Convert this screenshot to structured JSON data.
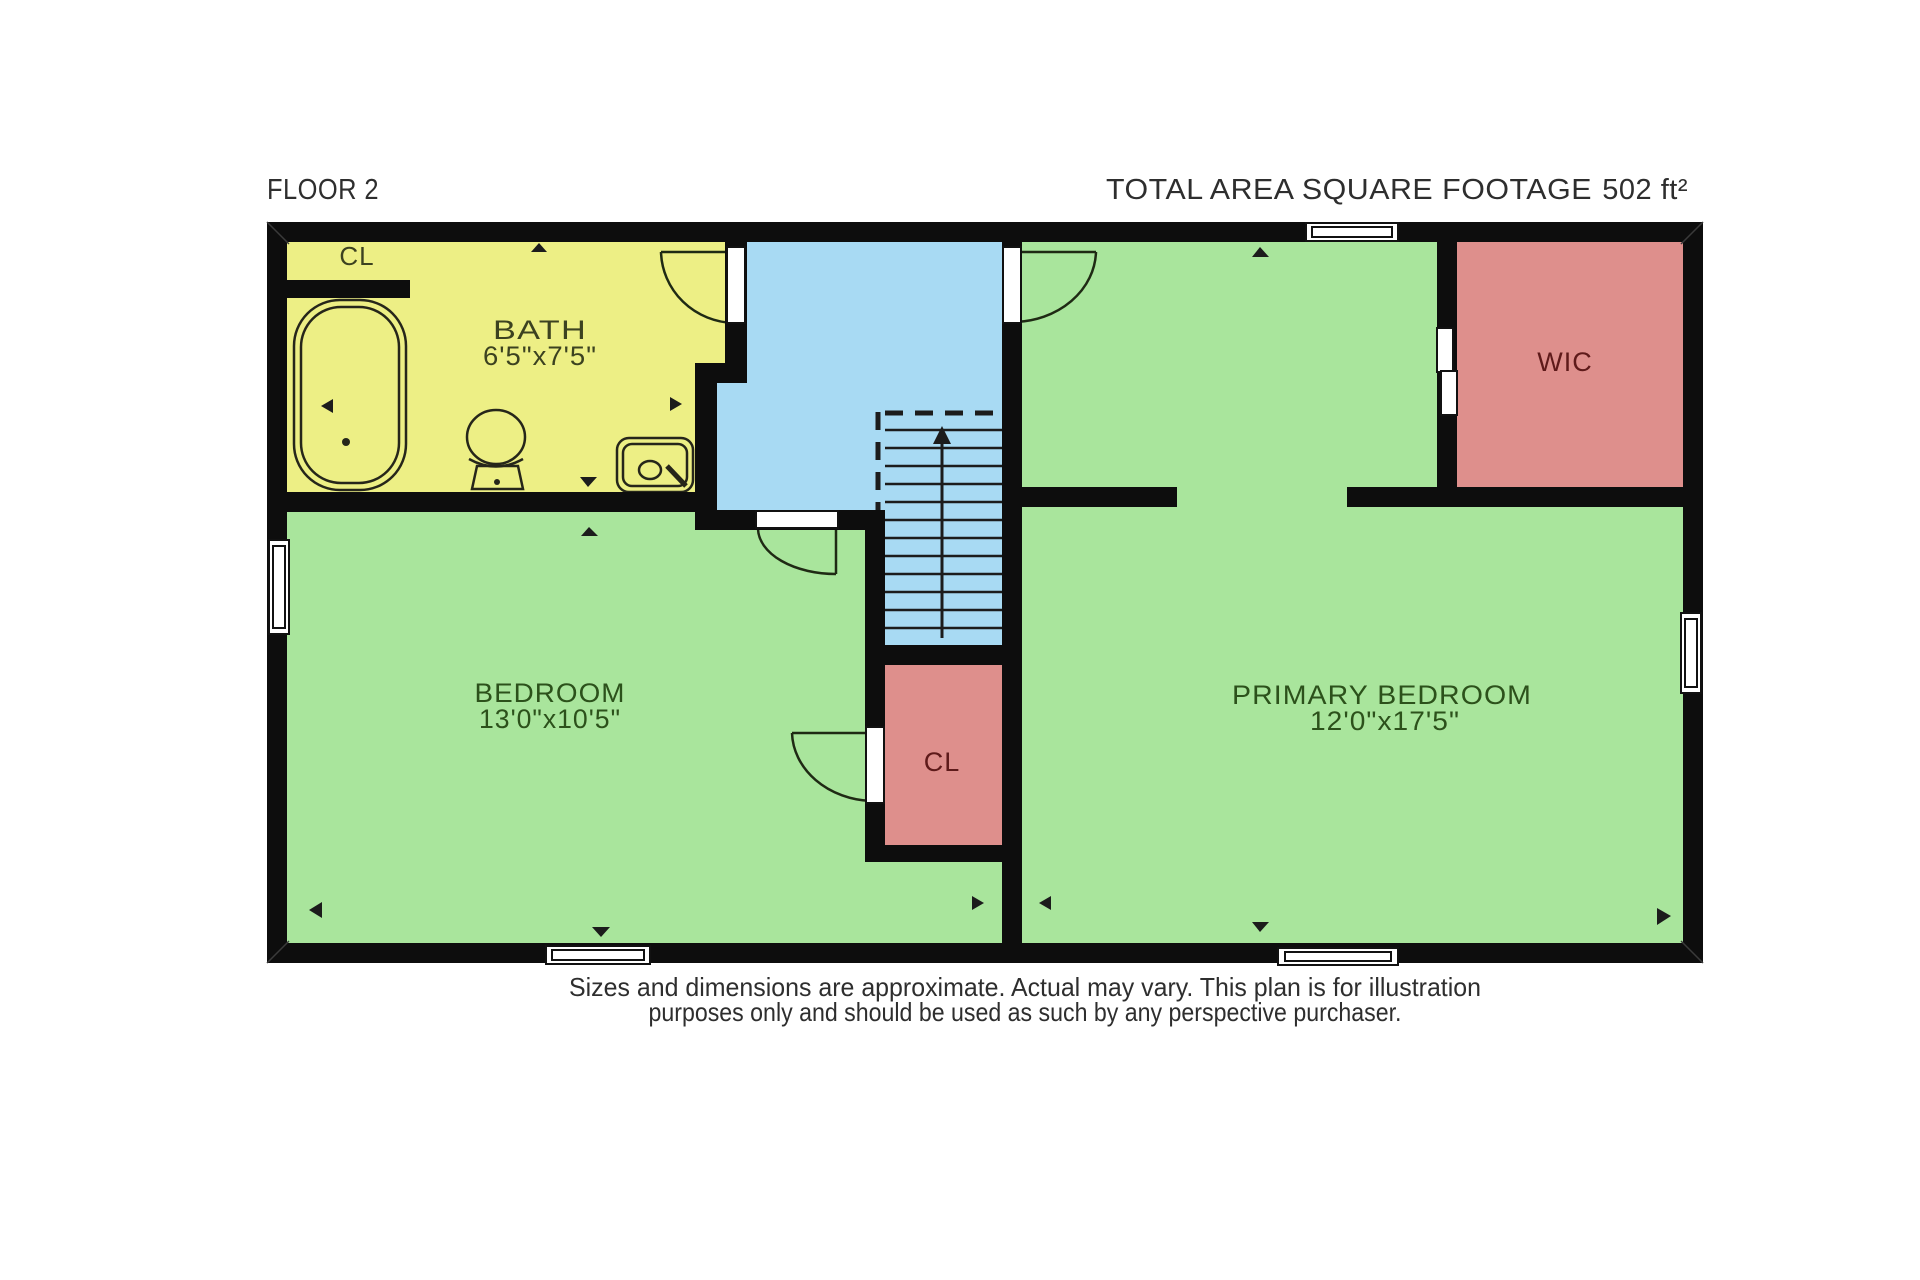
{
  "header": {
    "floor_label": "FLOOR 2",
    "total_area_label": "TOTAL AREA SQUARE FOOTAGE",
    "total_area_value": "502 ft²"
  },
  "rooms": {
    "bath": {
      "name": "BATH",
      "dimensions": "6'5\"x7'5\""
    },
    "bath_closet": {
      "name": "CL"
    },
    "bedroom": {
      "name": "BEDROOM",
      "dimensions": "13'0\"x10'5\""
    },
    "primary_bedroom": {
      "name": "PRIMARY BEDROOM",
      "dimensions": "12'0\"x17'5\""
    },
    "center_closet": {
      "name": "CL"
    },
    "wic": {
      "name": "WIC"
    }
  },
  "disclaimer": {
    "line1": "Sizes and dimensions are approximate. Actual may vary. This plan is for illustration",
    "line2": "purposes only and should be used as such by any perspective purchaser."
  },
  "colors": {
    "wall": "#0d0d0d",
    "bath": "#edef85",
    "hall": "#a8daf3",
    "bedroom": "#a9e59c",
    "primary_bedroom": "#a9e59c",
    "closet": "#de8f8c",
    "wic": "#de8f8c",
    "bath_label": "#3c4220",
    "green_label": "#2c511b",
    "pink_label": "#5e1a1a",
    "header_text": "#2e2e2e",
    "disclaimer_text": "#2e2e2e",
    "fixture_stroke": "#26261a",
    "stair_detail": "#1c1c1c",
    "door_arc": "#1f2a14",
    "window_fill": "#ffffff"
  }
}
